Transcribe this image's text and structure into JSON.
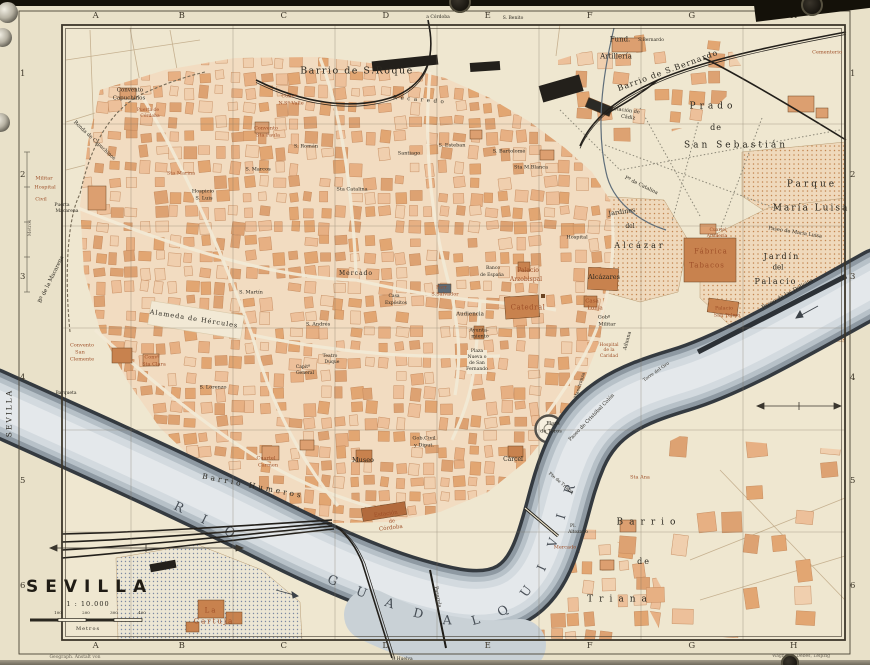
{
  "map": {
    "colors": {
      "k": "#2b2820",
      "r": "#9e4f28",
      "g": "#6b6557",
      "w": "#353c44",
      "paper": "#e9e1c9",
      "block": "#e7b083",
      "water": "#b6bfc6"
    },
    "title_block": {
      "title": "SEVILLA",
      "scale": "1 : 10.000",
      "unit": "Metros",
      "ticks": [
        "100",
        "200",
        "300",
        "400"
      ]
    },
    "grid": {
      "cols": [
        "A",
        "B",
        "C",
        "D",
        "E",
        "F",
        "G",
        "H"
      ],
      "rows": [
        "1",
        "2",
        "3",
        "4",
        "5",
        "6"
      ]
    },
    "river_name": "RIO GUADALQUIVIR",
    "labels": [
      {
        "t": "Convento",
        "x": 130,
        "y": 91,
        "s": 5.5
      },
      {
        "t": "Capuchinos",
        "x": 129,
        "y": 99,
        "s": 5.5
      },
      {
        "t": "Puerta de",
        "x": 148,
        "y": 111,
        "s": 4.5,
        "c": "r"
      },
      {
        "t": "Córdoba",
        "x": 150,
        "y": 117,
        "s": 4.5,
        "c": "r"
      },
      {
        "t": "Ronda de Capuchinos",
        "x": 94,
        "y": 141,
        "s": 5,
        "r": 43
      },
      {
        "t": "Militar",
        "x": 44,
        "y": 179,
        "s": 5,
        "c": "r"
      },
      {
        "t": "Hospital",
        "x": 45,
        "y": 188,
        "s": 5,
        "c": "r"
      },
      {
        "t": "Civil",
        "x": 41,
        "y": 200,
        "s": 5,
        "c": "r"
      },
      {
        "t": "Puerta",
        "x": 62,
        "y": 206,
        "s": 4.5
      },
      {
        "t": "Macarena",
        "x": 67,
        "y": 212,
        "s": 4.5
      },
      {
        "t": "Bº de la Macarena",
        "x": 52,
        "y": 280,
        "s": 5.5,
        "r": -64
      },
      {
        "t": "Convento",
        "x": 82,
        "y": 346,
        "s": 5,
        "c": "r"
      },
      {
        "t": "San",
        "x": 80,
        "y": 353,
        "s": 5,
        "c": "r"
      },
      {
        "t": "Clemente",
        "x": 82,
        "y": 360,
        "s": 5,
        "c": "r"
      },
      {
        "t": "Convº",
        "x": 152,
        "y": 358,
        "s": 5,
        "c": "r"
      },
      {
        "t": "Sta Clara",
        "x": 154,
        "y": 365,
        "s": 5,
        "c": "r"
      },
      {
        "t": "Barqueta",
        "x": 66,
        "y": 394,
        "s": 4.5
      },
      {
        "t": "S. Lorenzo",
        "x": 213,
        "y": 388,
        "s": 5
      },
      {
        "t": "Sta Marina",
        "x": 181,
        "y": 174,
        "s": 5,
        "c": "r"
      },
      {
        "t": "Hospicio",
        "x": 203,
        "y": 192,
        "s": 5
      },
      {
        "t": "S. Luis",
        "x": 204,
        "y": 199,
        "s": 5
      },
      {
        "t": "S. Marcos",
        "x": 258,
        "y": 170,
        "s": 5
      },
      {
        "t": "S. Román",
        "x": 306,
        "y": 147,
        "s": 5
      },
      {
        "t": "Convento",
        "x": 266,
        "y": 129,
        "s": 5,
        "c": "r"
      },
      {
        "t": "Sta Paula",
        "x": 268,
        "y": 136,
        "s": 5,
        "c": "r"
      },
      {
        "t": "Convº",
        "x": 289,
        "y": 97,
        "s": 5,
        "c": "r"
      },
      {
        "t": "N.Sª Valle",
        "x": 291,
        "y": 104,
        "s": 5,
        "c": "r"
      },
      {
        "t": "Barrio de S.Roque",
        "x": 357,
        "y": 71,
        "s": 9.5,
        "ls": 1.5
      },
      {
        "t": "Recaredo",
        "x": 420,
        "y": 101,
        "s": 5.5,
        "ls": 3.5,
        "r": 5
      },
      {
        "t": "Santiago",
        "x": 409,
        "y": 154,
        "s": 5
      },
      {
        "t": "S. Esteban",
        "x": 452,
        "y": 146,
        "s": 5
      },
      {
        "t": "S. Bartolomé",
        "x": 509,
        "y": 152,
        "s": 5
      },
      {
        "t": "Sta M.Blanca",
        "x": 531,
        "y": 168,
        "s": 5
      },
      {
        "t": "Sta Catalina",
        "x": 352,
        "y": 190,
        "s": 5
      },
      {
        "t": "S. Martín",
        "x": 251,
        "y": 293,
        "s": 5
      },
      {
        "t": "S. Andrés",
        "x": 318,
        "y": 325,
        "s": 5
      },
      {
        "t": "Mercado",
        "x": 356,
        "y": 274,
        "s": 6,
        "ls": 1
      },
      {
        "t": "Alameda de Hércules",
        "x": 194,
        "y": 319,
        "s": 6.5,
        "ls": 1,
        "r": 9
      },
      {
        "t": "Capitª",
        "x": 303,
        "y": 368,
        "s": 4.5
      },
      {
        "t": "General",
        "x": 305,
        "y": 374,
        "s": 4.5
      },
      {
        "t": "Teatro",
        "x": 330,
        "y": 357,
        "s": 4.5
      },
      {
        "t": "Duque",
        "x": 332,
        "y": 363,
        "s": 4.5
      },
      {
        "t": "Cuartel",
        "x": 266,
        "y": 459,
        "s": 5,
        "c": "r"
      },
      {
        "t": "Carmen",
        "x": 268,
        "y": 466,
        "s": 5,
        "c": "r"
      },
      {
        "t": "Barrio Humeros",
        "x": 253,
        "y": 486,
        "s": 7.5,
        "ls": 3,
        "r": 11
      },
      {
        "t": "Museo",
        "x": 363,
        "y": 460,
        "s": 6.5
      },
      {
        "t": "Estación",
        "x": 386,
        "y": 515,
        "s": 5.5,
        "r": -7,
        "c": "r"
      },
      {
        "t": "de",
        "x": 392,
        "y": 522,
        "s": 5,
        "r": -7,
        "c": "r"
      },
      {
        "t": "Córdoba",
        "x": 391,
        "y": 529,
        "s": 5.5,
        "r": -7,
        "c": "r"
      },
      {
        "t": "Gob.Civil",
        "x": 424,
        "y": 439,
        "s": 5
      },
      {
        "t": "y Diput.",
        "x": 424,
        "y": 446,
        "s": 5
      },
      {
        "t": "Cárcel",
        "x": 513,
        "y": 460,
        "s": 6
      },
      {
        "t": "Parr.",
        "x": 442,
        "y": 288,
        "s": 5,
        "c": "r"
      },
      {
        "t": "S.Salvador",
        "x": 445,
        "y": 295,
        "s": 5,
        "c": "r"
      },
      {
        "t": "Casa",
        "x": 394,
        "y": 297,
        "s": 4.5
      },
      {
        "t": "Expósitos",
        "x": 396,
        "y": 304,
        "s": 4.5
      },
      {
        "t": "Banco",
        "x": 493,
        "y": 269,
        "s": 4.5
      },
      {
        "t": "de España",
        "x": 492,
        "y": 276,
        "s": 4.5
      },
      {
        "t": "Audiencia",
        "x": 470,
        "y": 315,
        "s": 5.5
      },
      {
        "t": "Ayunta-",
        "x": 479,
        "y": 331,
        "s": 5
      },
      {
        "t": "miento",
        "x": 480,
        "y": 337,
        "s": 5
      },
      {
        "t": "Plaza",
        "x": 477,
        "y": 352,
        "s": 4.5
      },
      {
        "t": "Nueva o",
        "x": 477,
        "y": 358,
        "s": 4.5
      },
      {
        "t": "de San",
        "x": 477,
        "y": 364,
        "s": 4.5
      },
      {
        "t": "Fernando",
        "x": 477,
        "y": 370,
        "s": 4.5
      },
      {
        "t": "Palacio",
        "x": 528,
        "y": 271,
        "s": 6,
        "c": "r"
      },
      {
        "t": "Arzobispal",
        "x": 526,
        "y": 280,
        "s": 6,
        "c": "r"
      },
      {
        "t": "Catedral",
        "x": 528,
        "y": 308,
        "s": 7,
        "ls": 0.5,
        "c": "r"
      },
      {
        "t": "Casa",
        "x": 592,
        "y": 302,
        "s": 5.5,
        "c": "r"
      },
      {
        "t": "Lonja",
        "x": 595,
        "y": 309,
        "s": 5.5,
        "c": "r"
      },
      {
        "t": "Gobº",
        "x": 604,
        "y": 318,
        "s": 5
      },
      {
        "t": "Militar",
        "x": 607,
        "y": 325,
        "s": 5
      },
      {
        "t": "Alcázares",
        "x": 604,
        "y": 277,
        "s": 6.5
      },
      {
        "t": "Hospital",
        "x": 577,
        "y": 238,
        "s": 5
      },
      {
        "t": "Jardines",
        "x": 622,
        "y": 212,
        "s": 6.5,
        "r": -8
      },
      {
        "t": "del",
        "x": 630,
        "y": 227,
        "s": 6
      },
      {
        "t": "Alcázar",
        "x": 640,
        "y": 246,
        "s": 8,
        "ls": 3
      },
      {
        "t": "Pº de Catalina",
        "x": 641,
        "y": 186,
        "s": 5,
        "r": 26
      },
      {
        "t": "Hospital",
        "x": 609,
        "y": 346,
        "s": 4.5,
        "c": "r"
      },
      {
        "t": "de la",
        "x": 609,
        "y": 351,
        "s": 4.5,
        "c": "r"
      },
      {
        "t": "Caridad",
        "x": 609,
        "y": 357,
        "s": 4.5,
        "c": "r"
      },
      {
        "t": "Aduana",
        "x": 628,
        "y": 341,
        "s": 5,
        "r": -75
      },
      {
        "t": "Maestranza",
        "x": 581,
        "y": 386,
        "s": 4.5,
        "r": -72
      },
      {
        "t": "Torre del Oro",
        "x": 657,
        "y": 373,
        "s": 4.5,
        "r": -35
      },
      {
        "t": "Paseo de Cristóbal Colón",
        "x": 592,
        "y": 418,
        "s": 5,
        "r": -46
      },
      {
        "t": "Plaza",
        "x": 553,
        "y": 424,
        "s": 5
      },
      {
        "t": "de Toros",
        "x": 551,
        "y": 432,
        "s": 5
      },
      {
        "t": "Pte de Triana",
        "x": 560,
        "y": 484,
        "s": 4.5,
        "r": 40
      },
      {
        "t": "Pl.",
        "x": 573,
        "y": 527,
        "s": 4.5
      },
      {
        "t": "Altozano",
        "x": 578,
        "y": 533,
        "s": 4.5
      },
      {
        "t": "Mercado",
        "x": 565,
        "y": 548,
        "s": 5,
        "c": "r"
      },
      {
        "t": "Sta Ana",
        "x": 640,
        "y": 478,
        "s": 5,
        "c": "r"
      },
      {
        "t": "Pasarela",
        "x": 437,
        "y": 597,
        "s": 5,
        "r": 80
      },
      {
        "t": "Barrio",
        "x": 649,
        "y": 523,
        "s": 9,
        "ls": 6
      },
      {
        "t": "de",
        "x": 644,
        "y": 562,
        "s": 8,
        "ls": 2
      },
      {
        "t": "Triana",
        "x": 620,
        "y": 600,
        "s": 9,
        "ls": 6
      },
      {
        "t": "La",
        "x": 211,
        "y": 611,
        "s": 7,
        "ls": 2,
        "c": "r"
      },
      {
        "t": "Cartuja",
        "x": 214,
        "y": 622,
        "s": 7,
        "ls": 2,
        "c": "r"
      },
      {
        "t": "Fund.",
        "x": 620,
        "y": 40,
        "s": 7
      },
      {
        "t": "Artillería",
        "x": 616,
        "y": 57,
        "s": 7
      },
      {
        "t": "S.Bernardo",
        "x": 651,
        "y": 41,
        "s": 4.5
      },
      {
        "t": "Barrio de S.Bernardo",
        "x": 668,
        "y": 71,
        "s": 8,
        "ls": 1,
        "r": -20
      },
      {
        "t": "Estación de",
        "x": 625,
        "y": 111,
        "s": 5,
        "r": 8
      },
      {
        "t": "Cádiz",
        "x": 628,
        "y": 118,
        "s": 5,
        "r": 8
      },
      {
        "t": "Cementerio",
        "x": 827,
        "y": 53,
        "s": 5,
        "c": "r"
      },
      {
        "t": "Prado",
        "x": 713,
        "y": 107,
        "s": 9,
        "ls": 4
      },
      {
        "t": "de",
        "x": 716,
        "y": 128,
        "s": 8,
        "ls": 1
      },
      {
        "t": "San Sebastián",
        "x": 736,
        "y": 146,
        "s": 9,
        "ls": 3
      },
      {
        "t": "Parque",
        "x": 812,
        "y": 185,
        "s": 9,
        "ls": 3
      },
      {
        "t": "María Luisa",
        "x": 811,
        "y": 209,
        "s": 9,
        "ls": 2
      },
      {
        "t": "Paseo de María Luisa",
        "x": 795,
        "y": 233,
        "s": 5,
        "r": 9
      },
      {
        "t": "Cuartel",
        "x": 718,
        "y": 231,
        "s": 4.5,
        "c": "r"
      },
      {
        "t": "Artillería",
        "x": 717,
        "y": 237,
        "s": 4.5,
        "c": "r"
      },
      {
        "t": "Fábrica",
        "x": 711,
        "y": 252,
        "s": 7,
        "ls": 1,
        "c": "r"
      },
      {
        "t": "Tabacos",
        "x": 707,
        "y": 266,
        "s": 7,
        "ls": 1,
        "c": "r"
      },
      {
        "t": "Jardín",
        "x": 782,
        "y": 257,
        "s": 8,
        "ls": 2
      },
      {
        "t": "del",
        "x": 778,
        "y": 268,
        "s": 7
      },
      {
        "t": "Palacio",
        "x": 776,
        "y": 282,
        "s": 8,
        "ls": 2
      },
      {
        "t": "Palacio",
        "x": 724,
        "y": 309,
        "s": 5,
        "c": "r"
      },
      {
        "t": "San Telmo",
        "x": 727,
        "y": 316,
        "s": 5,
        "c": "r"
      },
      {
        "t": "Paseo de las Delicias",
        "x": 788,
        "y": 295,
        "s": 5.5,
        "r": -29
      },
      {
        "t": "Cruz del Campo",
        "x": 470,
        "y": 5,
        "s": 4.5
      },
      {
        "t": "a Alcalá d. Guad.",
        "x": 747,
        "y": 4,
        "s": 4.5
      },
      {
        "t": "a Córdoba",
        "x": 438,
        "y": 18,
        "s": 4.5
      },
      {
        "t": "S. Benito",
        "x": 513,
        "y": 19,
        "s": 4.5
      },
      {
        "t": "V. Huelva",
        "x": 402,
        "y": 660,
        "s": 4.5
      },
      {
        "t": "SEVILLA",
        "x": 9,
        "y": 413,
        "s": 7.5,
        "r": -90,
        "ls": 2
      },
      {
        "t": "Metros",
        "x": 31,
        "y": 228,
        "s": 4.5,
        "r": -90,
        "c": "g"
      },
      {
        "t": "Geograph. Anstalt von",
        "x": 75,
        "y": 658,
        "s": 4.5,
        "c": "g"
      },
      {
        "t": "Wagner & Debes, Leipzig",
        "x": 801,
        "y": 657,
        "s": 4.5,
        "c": "g"
      }
    ]
  }
}
